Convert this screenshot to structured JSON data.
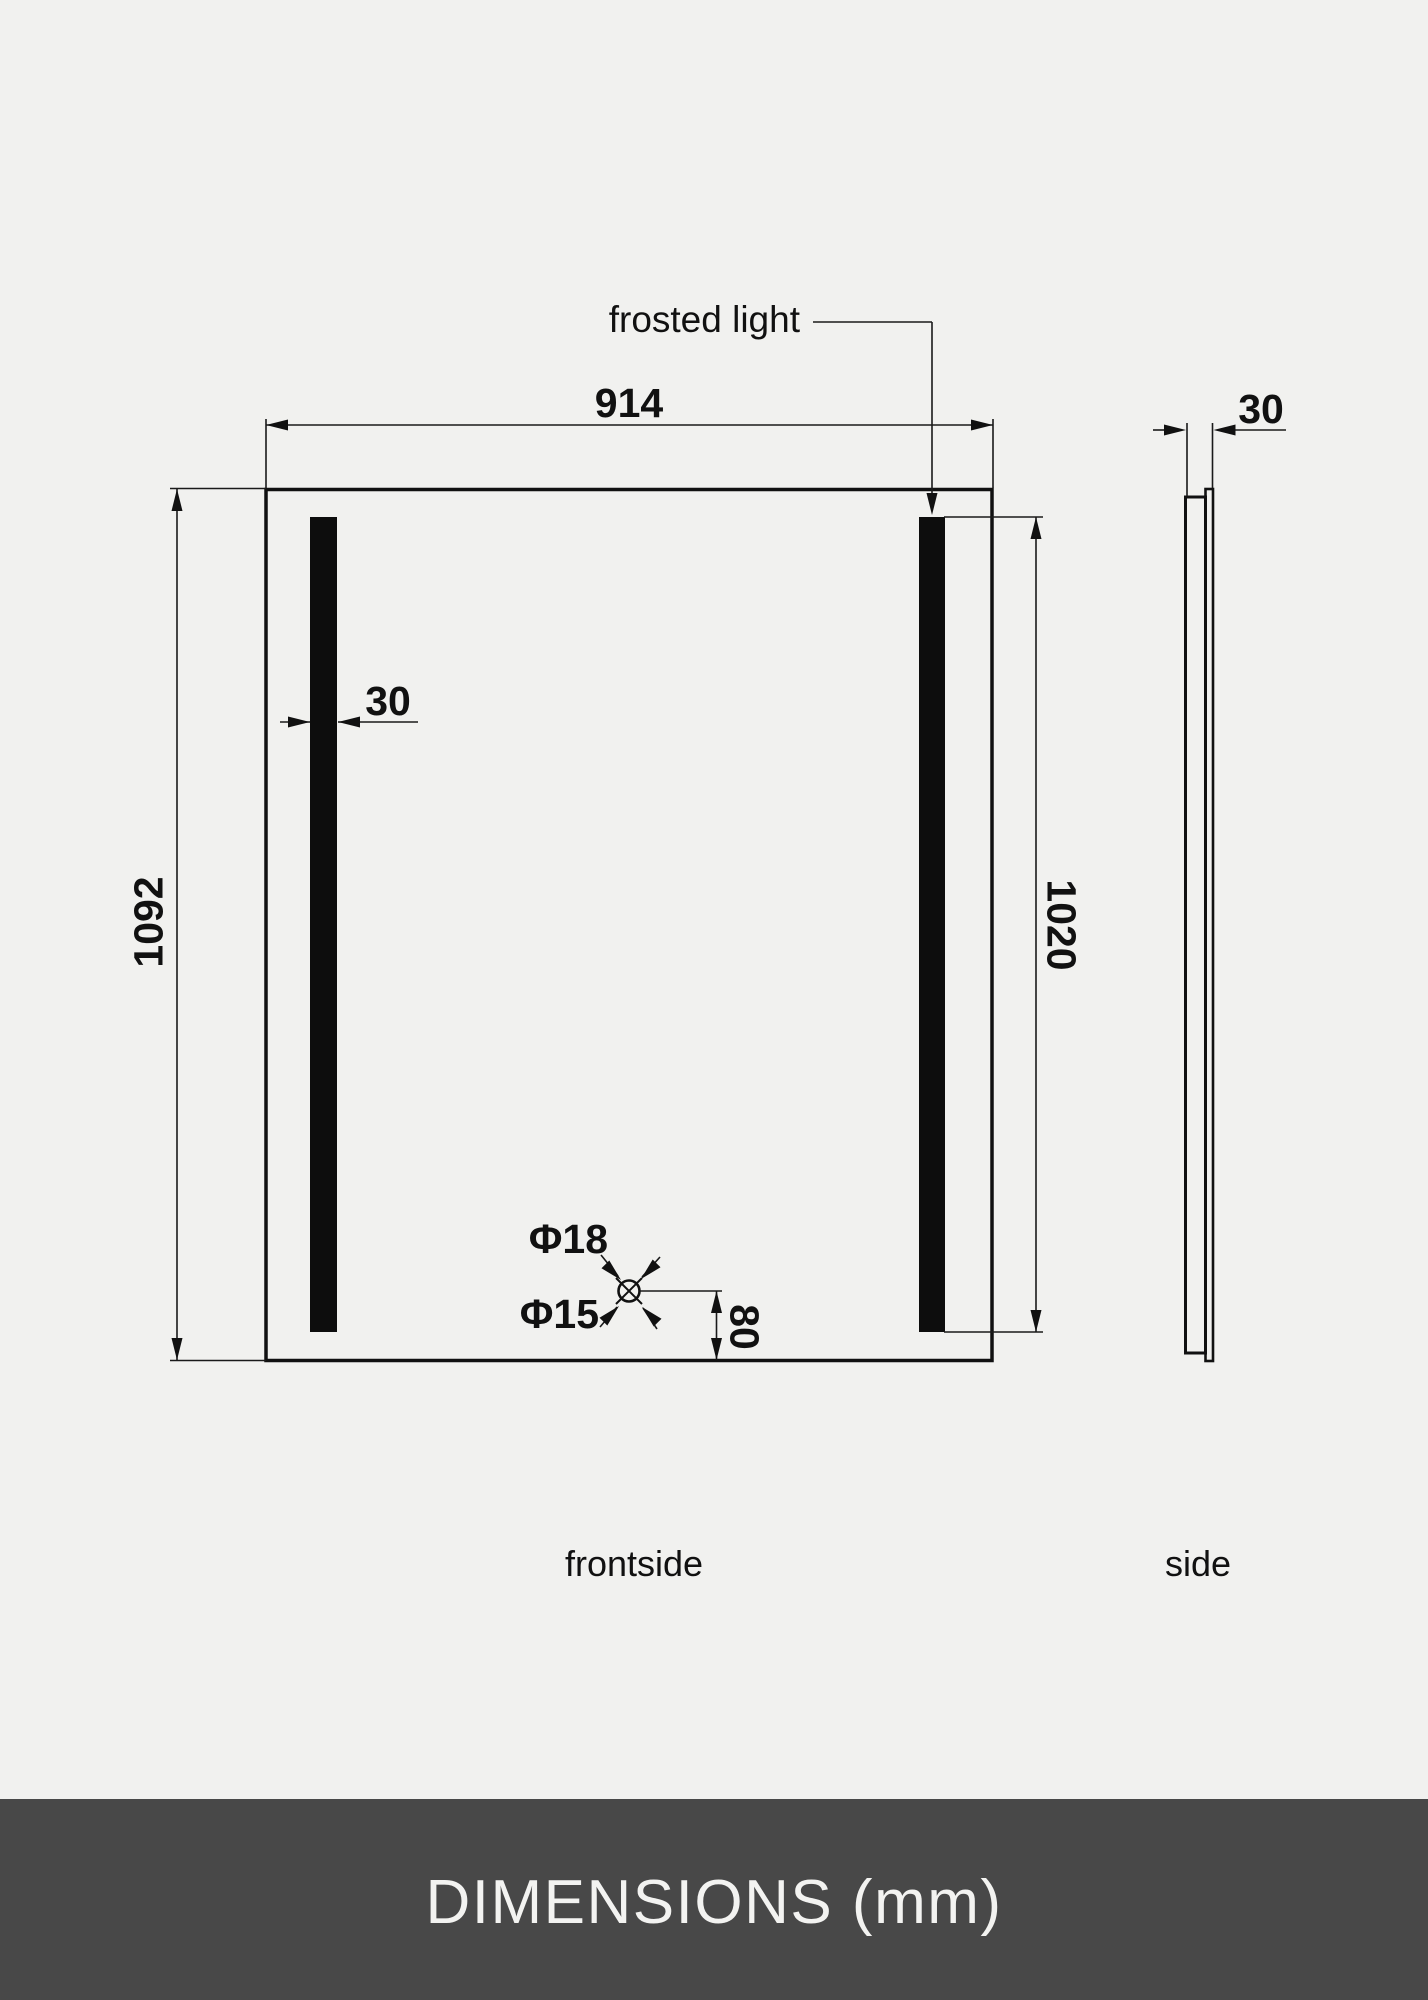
{
  "canvas": {
    "background_color": "#f1f1ef",
    "line_color": "#111111"
  },
  "views": {
    "front_label": "frontside",
    "side_label": "side"
  },
  "annotations": {
    "frosted_light": "frosted light",
    "width": "914",
    "height": "1092",
    "light_height": "1020",
    "light_bar_width": "30",
    "thickness": "30",
    "hole_outer_diameter": "Φ18",
    "hole_inner_diameter": "Φ15",
    "hole_bottom_offset": "80"
  },
  "footer": {
    "title": "DIMENSIONS (mm)",
    "background_color": "#484848",
    "text_color": "#f3f3f1"
  }
}
